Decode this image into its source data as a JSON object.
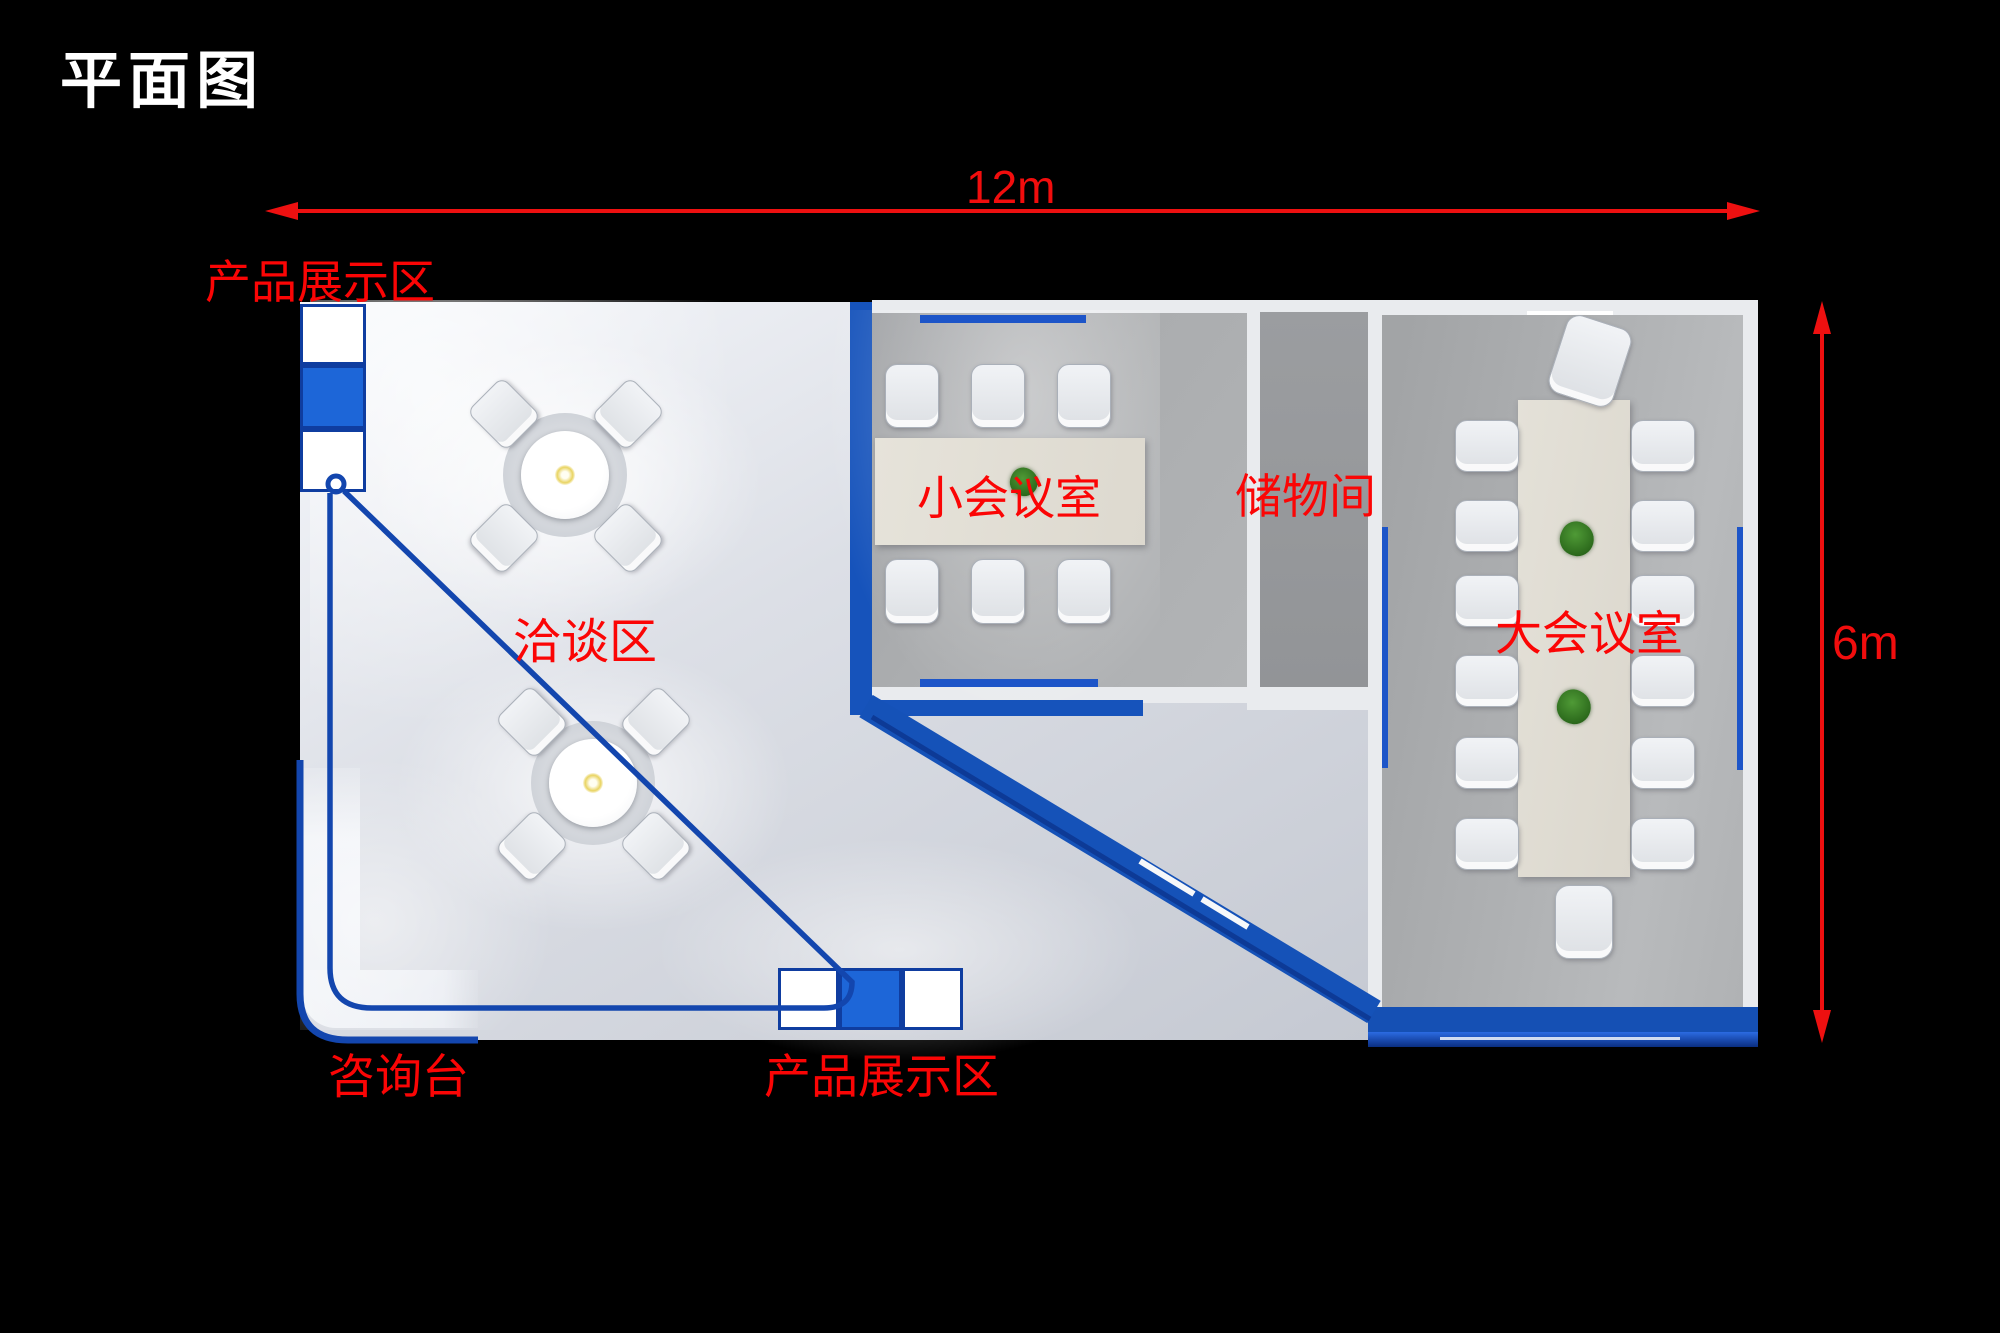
{
  "title": "平面图",
  "dimensions": {
    "width_label": "12m",
    "height_label": "6m"
  },
  "labels": {
    "product_display_top": "产品展示区",
    "negotiation_area": "洽谈区",
    "small_meeting_room": "小会议室",
    "storage_room": "储物间",
    "large_meeting_room": "大会议室",
    "information_desk": "咨询台",
    "product_display_bottom": "产品展示区"
  },
  "colors": {
    "background": "#000000",
    "wall_blue": "#1653bb",
    "cabinet_blue": "#1d66d8",
    "boundary_line_blue": "#1346ae",
    "label_red": "#fb0505",
    "dimension_red": "#f20d0d",
    "floor_light": "#dcdfe6",
    "room_gray": "#a9abad"
  }
}
